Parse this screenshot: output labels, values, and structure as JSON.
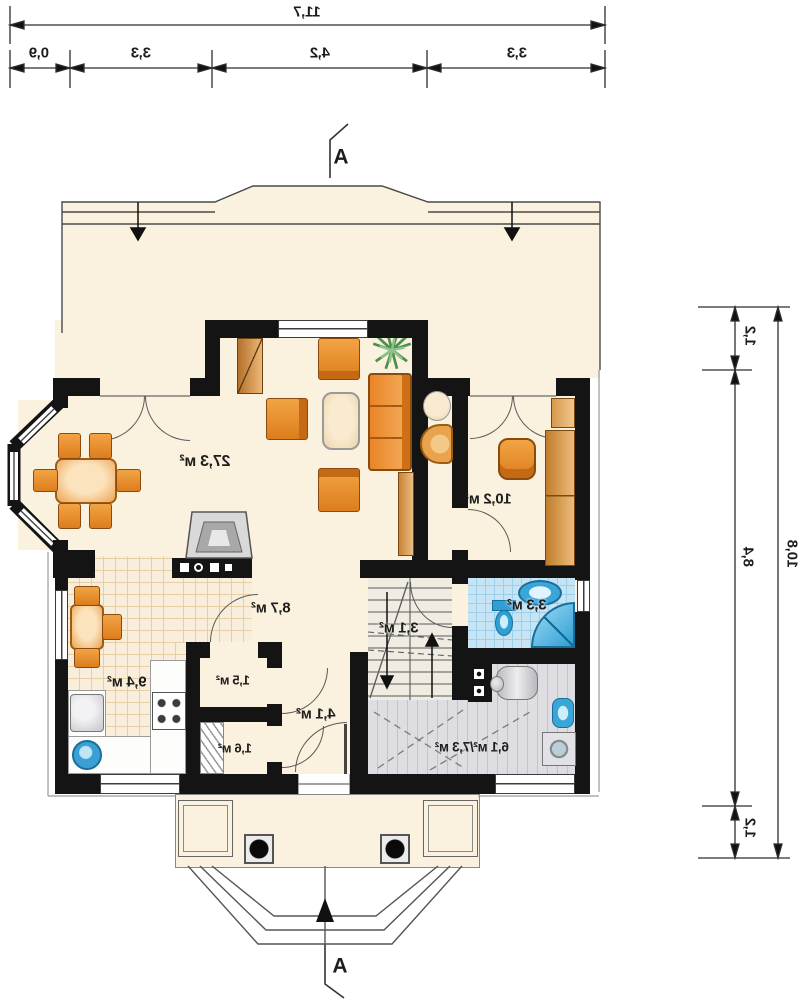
{
  "section_markers": {
    "top": "A",
    "bottom": "A"
  },
  "dimensions": {
    "top": {
      "total": "11,7",
      "segments": [
        "0,9",
        "3,3",
        "4,2",
        "3,3"
      ]
    },
    "right": {
      "total": "10,8",
      "segments": [
        "1,2",
        "8,4",
        "1,2"
      ]
    }
  },
  "rooms": [
    {
      "name": "living-dining-room",
      "area": "27,3 м²"
    },
    {
      "name": "study",
      "area": "10,2 м²"
    },
    {
      "name": "kitchen",
      "area": "9,4 м²"
    },
    {
      "name": "hall",
      "area": "8,7 м²"
    },
    {
      "name": "closet",
      "area": "1,5 м²"
    },
    {
      "name": "pantry",
      "area": "1,6 м²"
    },
    {
      "name": "vestibule",
      "area": "4,1 м²"
    },
    {
      "name": "staircase",
      "area": "3,1 м²"
    },
    {
      "name": "bathroom",
      "area": "3,3 м²"
    },
    {
      "name": "utility-room",
      "area": "6,1 м²/7,3 м²"
    }
  ],
  "colors": {
    "wall": "#141414",
    "floor_cream": "#faf1de",
    "furniture_orange": "#e98a2e",
    "bathroom_tile": "#c6e4f4",
    "utility_floor": "#dedee2",
    "plant_green": "#4e8f4e"
  }
}
